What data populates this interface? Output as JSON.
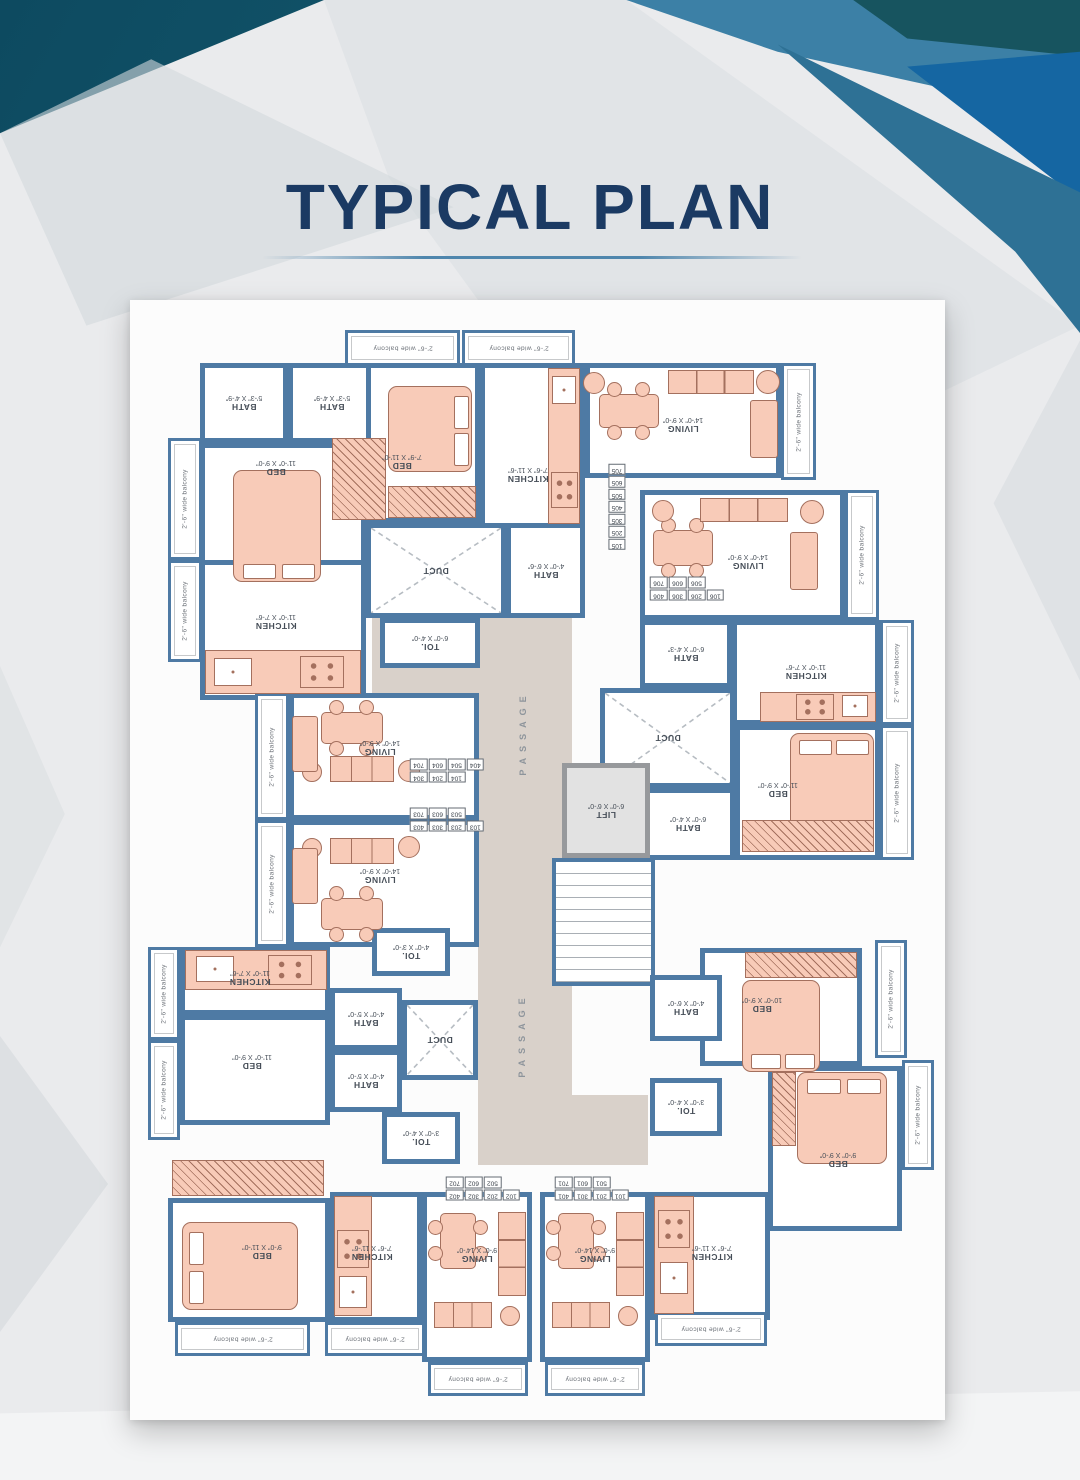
{
  "page": {
    "title": "TYPICAL PLAN"
  },
  "colors": {
    "wall": "#4e7aa4",
    "furniture": "#f8cbb8",
    "furniture_line": "#a4705e",
    "passage": "#d9d1ca",
    "title": "#1b3a63",
    "accent_teal": "#1e6e83",
    "accent_blue": "#3c80a6"
  },
  "plan": {
    "balcony_label": "2'-6\" wide balcony",
    "passage_label": "PASSAGE",
    "areas": [
      {
        "t": "passage",
        "x": 478,
        "y": 498,
        "w": 94,
        "h": 667
      },
      {
        "t": "passage",
        "x": 372,
        "y": 556,
        "w": 106,
        "h": 140
      },
      {
        "t": "passage",
        "x": 572,
        "y": 1095,
        "w": 76,
        "h": 70
      },
      {
        "t": "balc",
        "x": 345,
        "y": 330,
        "w": 115,
        "h": 36
      },
      {
        "t": "balc",
        "x": 462,
        "y": 330,
        "w": 113,
        "h": 36
      },
      {
        "t": "room",
        "x": 200,
        "y": 363,
        "w": 88,
        "h": 80,
        "n": "BATH",
        "d": "5'-3\" X 4'-9\""
      },
      {
        "t": "room",
        "x": 288,
        "y": 363,
        "w": 88,
        "h": 80,
        "n": "BATH",
        "d": "5'-3\" X 4'-9\""
      },
      {
        "t": "room",
        "x": 366,
        "y": 363,
        "w": 114,
        "h": 160,
        "n": "BED",
        "d": "7'-9\" X 11'-0\"",
        "lx": 402,
        "ly": 462
      },
      {
        "t": "room",
        "x": 480,
        "y": 363,
        "w": 105,
        "h": 167,
        "n": "KITCHEN",
        "d": "7'-6\" X 11'-6\"",
        "lx": 528,
        "ly": 475
      },
      {
        "t": "room",
        "x": 200,
        "y": 443,
        "w": 166,
        "h": 180,
        "n": "BED",
        "d": "11'-0\" X 9'-0\"",
        "lx": 276,
        "ly": 468
      },
      {
        "t": "balc",
        "x": 168,
        "y": 438,
        "w": 34,
        "h": 122,
        "v": 1
      },
      {
        "t": "balc",
        "x": 168,
        "y": 560,
        "w": 34,
        "h": 102,
        "v": 1
      },
      {
        "t": "room",
        "x": 200,
        "y": 560,
        "w": 166,
        "h": 140,
        "n": "KITCHEN",
        "d": "11'-0\" X 7'-6\"",
        "lx": 276,
        "ly": 622
      },
      {
        "t": "duct",
        "x": 366,
        "y": 523,
        "w": 140,
        "h": 95,
        "n": "DUCT"
      },
      {
        "t": "room",
        "x": 506,
        "y": 523,
        "w": 79,
        "h": 95,
        "n": "BATH",
        "d": "4'-0\" X 6'-6\""
      },
      {
        "t": "room",
        "x": 380,
        "y": 618,
        "w": 100,
        "h": 50,
        "n": "TOI.",
        "d": "6'-0\" X 4'-0\""
      },
      {
        "t": "room",
        "x": 585,
        "y": 363,
        "w": 196,
        "h": 115,
        "n": "LIVING",
        "d": "14'-0\" X 9'-0\"",
        "ly": 425
      },
      {
        "t": "balc",
        "x": 781,
        "y": 363,
        "w": 35,
        "h": 117,
        "v": 1
      },
      {
        "t": "room",
        "x": 640,
        "y": 490,
        "w": 205,
        "h": 130,
        "n": "LIVING",
        "d": "14'-0\" X 9'-0\"",
        "lx": 748,
        "ly": 562
      },
      {
        "t": "balc",
        "x": 845,
        "y": 490,
        "w": 34,
        "h": 130,
        "v": 1
      },
      {
        "t": "room",
        "x": 640,
        "y": 620,
        "w": 92,
        "h": 68,
        "n": "BATH",
        "d": "6'-0\" X 4'-3\""
      },
      {
        "t": "room",
        "x": 732,
        "y": 620,
        "w": 148,
        "h": 105,
        "n": "KITCHEN",
        "d": "11'-0\" X 7'-6\"",
        "ly": 672
      },
      {
        "t": "balc",
        "x": 880,
        "y": 620,
        "w": 34,
        "h": 105,
        "v": 1
      },
      {
        "t": "duct",
        "x": 600,
        "y": 688,
        "w": 135,
        "h": 100,
        "n": "DUCT"
      },
      {
        "t": "room",
        "x": 735,
        "y": 725,
        "w": 145,
        "h": 135,
        "n": "BED",
        "d": "11'-0\" X 9'-0\"",
        "lx": 778,
        "ly": 790
      },
      {
        "t": "balc",
        "x": 880,
        "y": 725,
        "w": 34,
        "h": 135,
        "v": 1
      },
      {
        "t": "room",
        "x": 640,
        "y": 788,
        "w": 95,
        "h": 72,
        "n": "BATH",
        "d": "6'-0\" X 4'-0\""
      },
      {
        "t": "lift",
        "x": 562,
        "y": 763,
        "w": 88,
        "h": 95,
        "n": "LIFT",
        "d": "6'-0\" X 6'-0\""
      },
      {
        "t": "stairs",
        "x": 552,
        "y": 858,
        "w": 103,
        "h": 128
      },
      {
        "t": "balc",
        "x": 255,
        "y": 693,
        "w": 34,
        "h": 127,
        "v": 1
      },
      {
        "t": "room",
        "x": 289,
        "y": 693,
        "w": 190,
        "h": 127,
        "n": "LIVING",
        "d": "14'-0\" X 9'-0\"",
        "lx": 380,
        "ly": 748
      },
      {
        "t": "balc",
        "x": 255,
        "y": 820,
        "w": 34,
        "h": 127,
        "v": 1
      },
      {
        "t": "room",
        "x": 289,
        "y": 820,
        "w": 190,
        "h": 127,
        "n": "LIVING",
        "d": "14'-0\" X 9'-0\"",
        "lx": 380,
        "ly": 876
      },
      {
        "t": "room",
        "x": 180,
        "y": 947,
        "w": 150,
        "h": 68,
        "n": "KITCHEN",
        "d": "11'-0\" X 7'-6\"",
        "lx": 250,
        "ly": 978
      },
      {
        "t": "balc",
        "x": 148,
        "y": 947,
        "w": 32,
        "h": 93,
        "v": 1
      },
      {
        "t": "room",
        "x": 180,
        "y": 1015,
        "w": 150,
        "h": 110,
        "n": "BED",
        "d": "11'-0\" X 9'-0\"",
        "lx": 252,
        "ly": 1062
      },
      {
        "t": "balc",
        "x": 148,
        "y": 1040,
        "w": 32,
        "h": 100,
        "v": 1
      },
      {
        "t": "room",
        "x": 330,
        "y": 988,
        "w": 72,
        "h": 62,
        "n": "BATH",
        "d": "4'-0\" X 5'-0\""
      },
      {
        "t": "room",
        "x": 330,
        "y": 1050,
        "w": 72,
        "h": 62,
        "n": "BATH",
        "d": "4'-0\" X 5'-0\""
      },
      {
        "t": "room",
        "x": 372,
        "y": 928,
        "w": 78,
        "h": 48,
        "n": "TOI.",
        "d": "4'-0\" X 3'-0\""
      },
      {
        "t": "duct",
        "x": 402,
        "y": 1000,
        "w": 76,
        "h": 80,
        "n": "DUCT"
      },
      {
        "t": "room",
        "x": 382,
        "y": 1112,
        "w": 78,
        "h": 52,
        "n": "TOI.",
        "d": "3'-0\" X 4'-0\""
      },
      {
        "t": "room",
        "x": 168,
        "y": 1198,
        "w": 162,
        "h": 124,
        "n": "BED",
        "d": "9'-0\" X 11'-0\"",
        "lx": 262,
        "ly": 1252
      },
      {
        "t": "balc",
        "x": 175,
        "y": 1322,
        "w": 135,
        "h": 34
      },
      {
        "t": "room",
        "x": 330,
        "y": 1192,
        "w": 92,
        "h": 130,
        "n": "KITCHEN",
        "d": "7'-6\" X 11'-6\"",
        "lx": 372,
        "ly": 1253
      },
      {
        "t": "balc",
        "x": 325,
        "y": 1322,
        "w": 100,
        "h": 34
      },
      {
        "t": "room",
        "x": 422,
        "y": 1192,
        "w": 110,
        "h": 170,
        "n": "LIVING",
        "d": "9'-0\" X 14'-0\"",
        "ly": 1255
      },
      {
        "t": "balc",
        "x": 428,
        "y": 1362,
        "w": 100,
        "h": 34
      },
      {
        "t": "room",
        "x": 540,
        "y": 1192,
        "w": 110,
        "h": 170,
        "n": "LIVING",
        "d": "9'-0\" X 14'-0\"",
        "ly": 1255
      },
      {
        "t": "balc",
        "x": 545,
        "y": 1362,
        "w": 100,
        "h": 34
      },
      {
        "t": "room",
        "x": 650,
        "y": 1192,
        "w": 120,
        "h": 128,
        "n": "KITCHEN",
        "d": "7'-6\" X 11'-6\"",
        "lx": 712,
        "ly": 1253
      },
      {
        "t": "balc",
        "x": 655,
        "y": 1312,
        "w": 112,
        "h": 34
      },
      {
        "t": "room",
        "x": 700,
        "y": 948,
        "w": 162,
        "h": 118,
        "n": "BED",
        "d": "10'-0\" X 9'-0\"",
        "lx": 762,
        "ly": 1005
      },
      {
        "t": "balc",
        "x": 875,
        "y": 940,
        "w": 32,
        "h": 118,
        "v": 1
      },
      {
        "t": "room",
        "x": 650,
        "y": 975,
        "w": 72,
        "h": 66,
        "n": "BATH",
        "d": "4'-0\" X 6'-0\""
      },
      {
        "t": "room",
        "x": 650,
        "y": 1078,
        "w": 72,
        "h": 58,
        "n": "TOI.",
        "d": "3'-0\" X 4'-0\""
      },
      {
        "t": "room",
        "x": 768,
        "y": 1066,
        "w": 134,
        "h": 165,
        "n": "BED",
        "d": "9'-0\" X 9'-0\"",
        "lx": 838,
        "ly": 1160
      },
      {
        "t": "balc",
        "x": 902,
        "y": 1060,
        "w": 32,
        "h": 110,
        "v": 1
      }
    ],
    "passage_labels": [
      {
        "x": 523,
        "y": 733
      },
      {
        "x": 522,
        "y": 1035
      }
    ],
    "unit_chips": [
      {
        "cx": 617,
        "cy": 507,
        "rows": [
          [
            "105"
          ],
          [
            "205"
          ],
          [
            "305"
          ],
          [
            "405"
          ],
          [
            "505"
          ],
          [
            "605"
          ],
          [
            "705"
          ]
        ]
      },
      {
        "cx": 687,
        "cy": 589,
        "rows": [
          [
            "106",
            "206",
            "306",
            "406"
          ],
          [
            "506",
            "606",
            "706"
          ]
        ]
      },
      {
        "cx": 447,
        "cy": 771,
        "rows": [
          [
            "104",
            "204",
            "304"
          ],
          [
            "404",
            "504",
            "604",
            "704"
          ]
        ]
      },
      {
        "cx": 447,
        "cy": 820,
        "rows": [
          [
            "103",
            "203",
            "303",
            "403"
          ],
          [
            "503",
            "603",
            "703"
          ]
        ]
      },
      {
        "cx": 483,
        "cy": 1189,
        "rows": [
          [
            "102",
            "202",
            "302",
            "402"
          ],
          [
            "502",
            "602",
            "702"
          ]
        ]
      },
      {
        "cx": 592,
        "cy": 1189,
        "rows": [
          [
            "101",
            "201",
            "301",
            "401"
          ],
          [
            "501",
            "601",
            "701"
          ]
        ]
      }
    ],
    "furniture": [
      {
        "k": "bed",
        "x": 233,
        "y": 470,
        "w": 88,
        "h": 112,
        "p": "b"
      },
      {
        "k": "bed",
        "x": 388,
        "y": 386,
        "w": 84,
        "h": 86,
        "p": "r"
      },
      {
        "k": "bed",
        "x": 790,
        "y": 733,
        "w": 84,
        "h": 100,
        "p": "t"
      },
      {
        "k": "bed",
        "x": 742,
        "y": 980,
        "w": 78,
        "h": 92,
        "p": "b"
      },
      {
        "k": "bed",
        "x": 797,
        "y": 1072,
        "w": 90,
        "h": 92,
        "p": "t"
      },
      {
        "k": "bed",
        "x": 182,
        "y": 1222,
        "w": 116,
        "h": 88,
        "p": "l"
      },
      {
        "k": "dining",
        "x": 596,
        "y": 382,
        "w": 64,
        "h": 56
      },
      {
        "k": "dining",
        "x": 650,
        "y": 518,
        "w": 64,
        "h": 58
      },
      {
        "k": "dining",
        "x": 318,
        "y": 700,
        "w": 66,
        "h": 54
      },
      {
        "k": "dining",
        "x": 318,
        "y": 886,
        "w": 66,
        "h": 54
      },
      {
        "k": "dining",
        "x": 428,
        "y": 1210,
        "w": 58,
        "h": 60
      },
      {
        "k": "dining",
        "x": 546,
        "y": 1210,
        "w": 58,
        "h": 60
      },
      {
        "k": "sofa3",
        "x": 668,
        "y": 370,
        "w": 86,
        "h": 24
      },
      {
        "k": "sofa1",
        "x": 750,
        "y": 400,
        "w": 28,
        "h": 58
      },
      {
        "k": "round",
        "x": 583,
        "y": 372,
        "w": 22,
        "h": 22
      },
      {
        "k": "round",
        "x": 756,
        "y": 370,
        "w": 24,
        "h": 24
      },
      {
        "k": "sofa3",
        "x": 700,
        "y": 498,
        "w": 88,
        "h": 24
      },
      {
        "k": "sofa1",
        "x": 790,
        "y": 532,
        "w": 28,
        "h": 58
      },
      {
        "k": "round",
        "x": 652,
        "y": 500,
        "w": 22,
        "h": 22
      },
      {
        "k": "round",
        "x": 800,
        "y": 500,
        "w": 24,
        "h": 24
      },
      {
        "k": "sofa3",
        "x": 330,
        "y": 756,
        "w": 64,
        "h": 26
      },
      {
        "k": "round",
        "x": 302,
        "y": 762,
        "w": 20,
        "h": 20
      },
      {
        "k": "round",
        "x": 398,
        "y": 760,
        "w": 22,
        "h": 22
      },
      {
        "k": "sofa1",
        "x": 292,
        "y": 716,
        "w": 26,
        "h": 56
      },
      {
        "k": "sofa3",
        "x": 330,
        "y": 838,
        "w": 64,
        "h": 26
      },
      {
        "k": "round",
        "x": 302,
        "y": 838,
        "w": 20,
        "h": 20
      },
      {
        "k": "round",
        "x": 398,
        "y": 836,
        "w": 22,
        "h": 22
      },
      {
        "k": "sofa1",
        "x": 292,
        "y": 848,
        "w": 26,
        "h": 56
      },
      {
        "k": "sofa3",
        "x": 498,
        "y": 1212,
        "w": 28,
        "h": 84
      },
      {
        "k": "sofa3",
        "x": 434,
        "y": 1302,
        "w": 58,
        "h": 26
      },
      {
        "k": "round",
        "x": 500,
        "y": 1306,
        "w": 20,
        "h": 20
      },
      {
        "k": "sofa3",
        "x": 616,
        "y": 1212,
        "w": 28,
        "h": 84
      },
      {
        "k": "sofa3",
        "x": 552,
        "y": 1302,
        "w": 58,
        "h": 26
      },
      {
        "k": "round",
        "x": 618,
        "y": 1306,
        "w": 20,
        "h": 20
      },
      {
        "k": "counter",
        "x": 548,
        "y": 368,
        "w": 32,
        "h": 156
      },
      {
        "k": "sink",
        "x": 552,
        "y": 376,
        "w": 24,
        "h": 28
      },
      {
        "k": "stove",
        "x": 551,
        "y": 472,
        "w": 27,
        "h": 36
      },
      {
        "k": "counter",
        "x": 205,
        "y": 650,
        "w": 156,
        "h": 44
      },
      {
        "k": "sink",
        "x": 214,
        "y": 658,
        "w": 38,
        "h": 28
      },
      {
        "k": "stove",
        "x": 300,
        "y": 656,
        "w": 44,
        "h": 32
      },
      {
        "k": "counter",
        "x": 760,
        "y": 692,
        "w": 116,
        "h": 30
      },
      {
        "k": "stove",
        "x": 796,
        "y": 694,
        "w": 38,
        "h": 26
      },
      {
        "k": "sink",
        "x": 842,
        "y": 695,
        "w": 26,
        "h": 22
      },
      {
        "k": "counter",
        "x": 185,
        "y": 950,
        "w": 142,
        "h": 40
      },
      {
        "k": "sink",
        "x": 196,
        "y": 956,
        "w": 38,
        "h": 26
      },
      {
        "k": "stove",
        "x": 268,
        "y": 955,
        "w": 44,
        "h": 30
      },
      {
        "k": "counter",
        "x": 334,
        "y": 1196,
        "w": 38,
        "h": 120
      },
      {
        "k": "stove",
        "x": 337,
        "y": 1230,
        "w": 32,
        "h": 38
      },
      {
        "k": "sink",
        "x": 339,
        "y": 1276,
        "w": 28,
        "h": 32
      },
      {
        "k": "counter",
        "x": 654,
        "y": 1196,
        "w": 40,
        "h": 118
      },
      {
        "k": "stove",
        "x": 658,
        "y": 1210,
        "w": 32,
        "h": 38
      },
      {
        "k": "sink",
        "x": 660,
        "y": 1262,
        "w": 28,
        "h": 32
      },
      {
        "k": "wardrobe",
        "x": 332,
        "y": 438,
        "w": 54,
        "h": 82
      },
      {
        "k": "wardrobe",
        "x": 388,
        "y": 486,
        "w": 88,
        "h": 32
      },
      {
        "k": "wardrobe",
        "x": 742,
        "y": 820,
        "w": 132,
        "h": 32
      },
      {
        "k": "wardrobe",
        "x": 745,
        "y": 952,
        "w": 112,
        "h": 26
      },
      {
        "k": "wardrobe",
        "x": 772,
        "y": 1072,
        "w": 24,
        "h": 74
      },
      {
        "k": "wardrobe",
        "x": 172,
        "y": 1160,
        "w": 152,
        "h": 36
      }
    ]
  }
}
